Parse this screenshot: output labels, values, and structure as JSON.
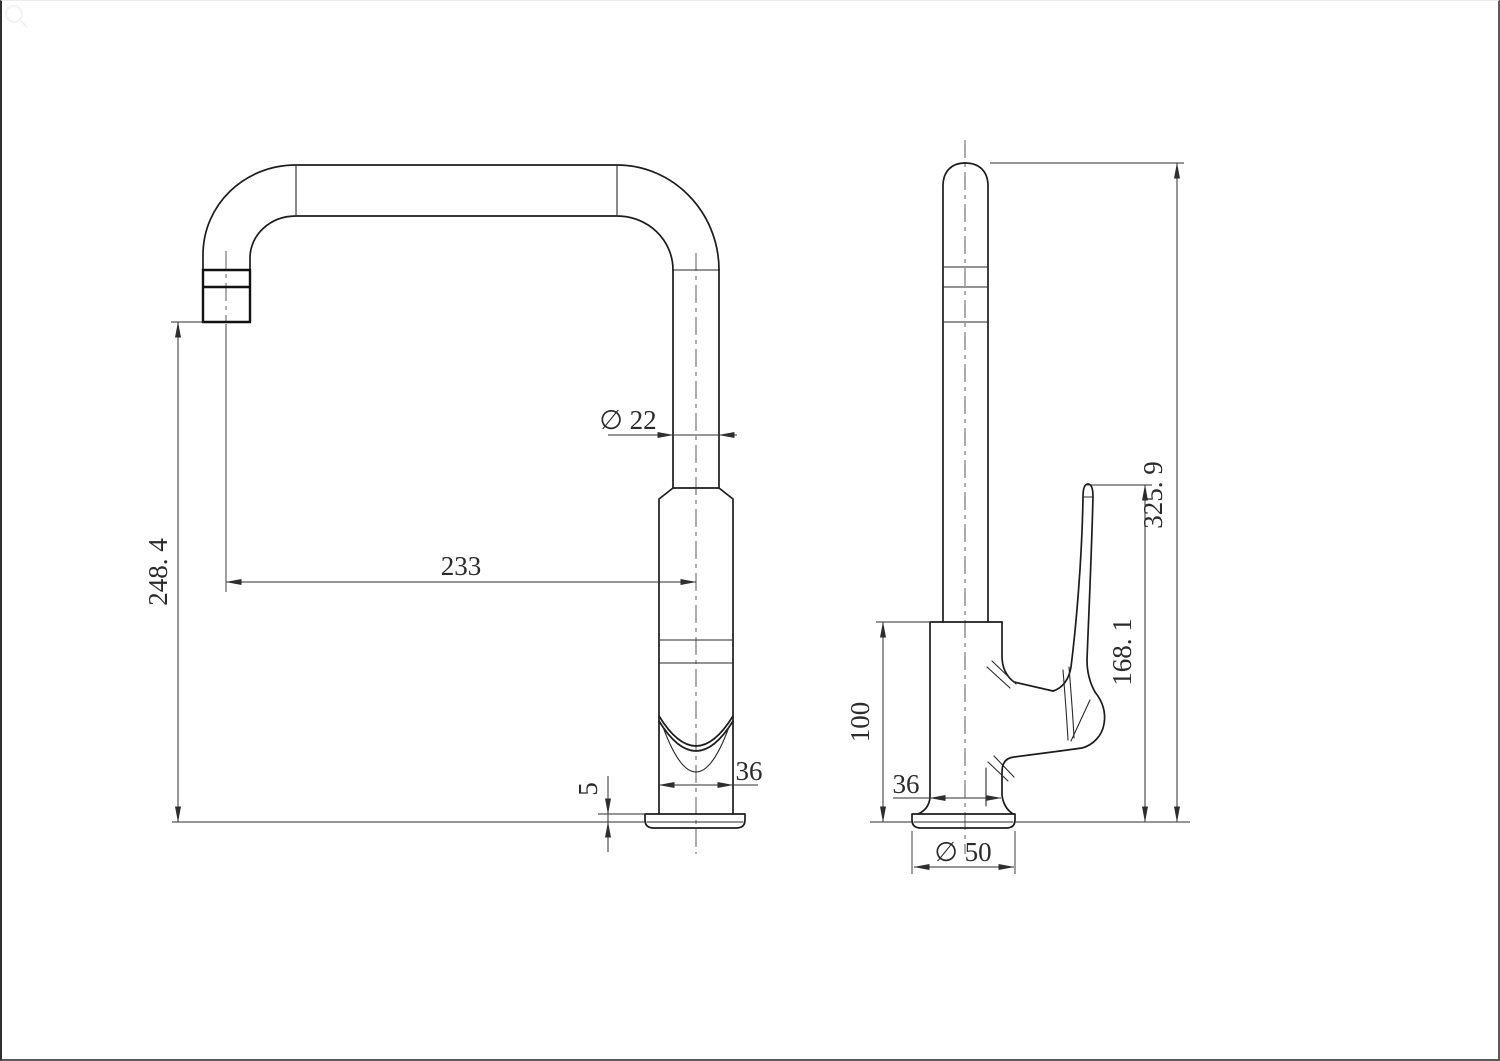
{
  "drawing": {
    "kind": "technical-drawing",
    "subject": "kitchen mixer tap, two orthographic views with dimensions",
    "units": "mm",
    "colors": {
      "background": "#ffffff",
      "object_line": "#1c1c1c",
      "dimension_line": "#2e2e2e",
      "centerline": "#4a4a4a"
    },
    "views": [
      {
        "id": "front-view",
        "label": "front view (spout arch)"
      },
      {
        "id": "side-view",
        "label": "side view (handle)"
      }
    ],
    "dimensions": {
      "spout_outlet_height": "248. 4",
      "spout_reach": "233",
      "spout_tube_diameter": "∅ 22",
      "body_width_front": "36",
      "base_plate_thickness": "5",
      "body_height": "100",
      "body_width_side": "36",
      "base_plate_diameter": "∅ 50",
      "handle_tip_height": "168. 1",
      "overall_height": "325. 9"
    }
  }
}
